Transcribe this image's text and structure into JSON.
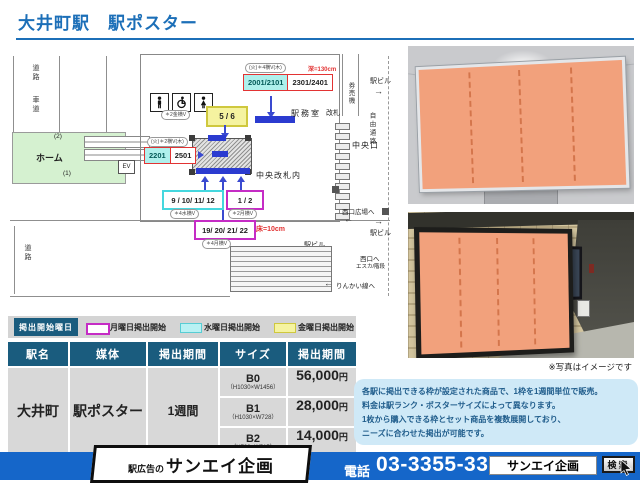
{
  "title": "大井町駅　駅ポスター",
  "map": {
    "road_upper": "道路",
    "lane_upper": "車道",
    "road_lower": "道路",
    "platform": "ホーム",
    "track_2": "(2)",
    "track_1": "(1)",
    "ev": "EV",
    "station_office": "駅務室",
    "ticket_machines": "券売機",
    "gate_label": "改札",
    "inside_central_gate": "中央改札内",
    "central_exit": "中央口",
    "free_passage": "自由通路",
    "bldg_top": "駅ビル",
    "bldg_top_arrow": "→",
    "bldg_mid": "駅ビル",
    "bldg_mid_arrow": "→",
    "bldg_lower": "駅ビル",
    "to_west_plaza": "西口広場へ",
    "west_plaza_arrow": "←",
    "to_west_exit": "西口へ",
    "west_exit_note": "エスカ/階段",
    "to_rinkai": "りんかい線へ",
    "rinkai_arrow": "←",
    "depth_note": "深=130cm",
    "floor_note": "床=10cm",
    "frames": {
      "f2001": "2001/2101",
      "f2301": "2301/2401",
      "f2001_note": "(火)＊4横V(木)",
      "f2201": "2201",
      "f2501": "2501",
      "f2201_note": "(火)＊2横V(木)",
      "f56": "5 / 6",
      "f56_note": "＊2金横V",
      "f9_12": "9 / 10/ 11/ 12",
      "f9_12_note": "＊4水横V",
      "f1_2": "1 / 2",
      "f1_2_note": "＊2月横V",
      "f19_22": "19/ 20/ 21/ 22",
      "f19_22_note": "＊4月横V"
    }
  },
  "legend": {
    "title": "掲出開始曜日",
    "items": [
      {
        "label": "月曜日掲出開始",
        "color": "#c52cc5"
      },
      {
        "label": "水曜日掲出開始",
        "color": "#57cdd4"
      },
      {
        "label": "金曜日掲出開始",
        "color": "#cfc83e"
      }
    ]
  },
  "table": {
    "headers": [
      "駅名",
      "媒体",
      "掲出期間",
      "サイズ",
      "掲出期間"
    ],
    "station": "大井町",
    "media": "駅ポスター",
    "period": "1週間",
    "rows": [
      {
        "size": "B0",
        "dims": "（H1030×W1456）",
        "price": "56,000",
        "unit": "円"
      },
      {
        "size": "B1",
        "dims": "（H1030×W728）",
        "price": "28,000",
        "unit": "円"
      },
      {
        "size": "B2",
        "dims": "（H728×W515）",
        "price": "14,000",
        "unit": "円"
      }
    ]
  },
  "photos": {
    "caption": "※写真はイメージです"
  },
  "info": {
    "lines": [
      "各駅に掲出できる枠が設定された商品で、1枠を1週間単位で販売。",
      "料金は駅ランク・ポスターサイズによって異なります。",
      "1枚から購入できる枠とセット商品を複数展開しており、",
      "ニーズに合わせた掲出が可能です。"
    ]
  },
  "footer": {
    "company_prefix": "駅広告の",
    "company": "サンエイ企画",
    "phone_label": "電話",
    "phone": "03-3355-3325",
    "search_value": "サンエイ企画",
    "search_button": "検索"
  },
  "colors": {
    "accent_blue": "#1c6fb8",
    "table_header": "#1a5c7e",
    "footer_blue": "#1566c9",
    "monday": "#c52cc5",
    "wednesday": "#57cdd4",
    "friday": "#cfc83e",
    "poster_salmon": "#f2a17c"
  }
}
